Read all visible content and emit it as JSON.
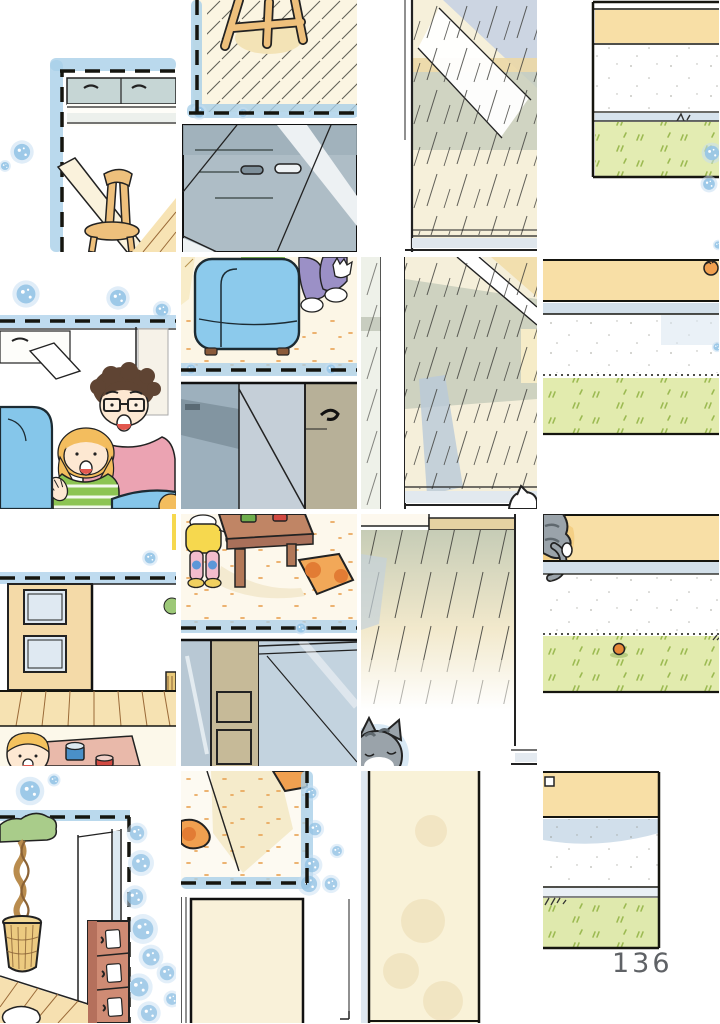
{
  "page": {
    "number": "136"
  },
  "illustration": {
    "kind": "scrambled watercolor manga-page illustration cut into 16 shuffled tiles",
    "grid": {
      "columns": 4,
      "rows": 4
    },
    "tiles": [
      {
        "id": "tile-kitchen-corner-chair",
        "desc": "kitchen wall cabinet corner, wooden chair and table edge, dashed panel border with blue watercolor"
      },
      {
        "id": "tile-stool-and-counter",
        "desc": "wooden stool on hatched floor above a gray kitchen counter block"
      },
      {
        "id": "tile-window-reflection",
        "desc": "glass pane with diagonal reflections, tan and green washes"
      },
      {
        "id": "tile-yard-strip-top",
        "desc": "horizontal bands: tan wall, white, sill, green grass strip"
      },
      {
        "id": "tile-family-peeking",
        "desc": "father with glasses and blond child smiling behind a blue sofa"
      },
      {
        "id": "tile-armchair-and-hallway",
        "desc": "blue armchair with seated legs above a dim hallway with door handle"
      },
      {
        "id": "tile-sliding-glass-door",
        "desc": "sliding glass door with washes, shadow and a white cat head below"
      },
      {
        "id": "tile-yard-strip-paw",
        "desc": "band strip with tiny orange paw, white band and grass"
      },
      {
        "id": "tile-door-and-play-table",
        "desc": "tan door with windows, wood floor, blond child with cups on a mat"
      },
      {
        "id": "tile-toddler-at-table",
        "desc": "toddler in yellow at brown table with cups, orange cushion, frames below"
      },
      {
        "id": "tile-deck-and-sleeping-cat",
        "desc": "hatched deck boards seen through glass, gray cat dozing at sill"
      },
      {
        "id": "tile-yard-strip-ball",
        "desc": "tabby cat tail over ledge, bands and grass with small orange ball"
      },
      {
        "id": "tile-plant-and-drawers",
        "desc": "braided topiary in basket, red-brown chest of drawers, heavy blue watercolor edge"
      },
      {
        "id": "tile-cushion-corner-door",
        "desc": "orange cushion corner on carpet above a cream door panel"
      },
      {
        "id": "tile-cream-door-panel",
        "desc": "tall cream door slab with black edges"
      },
      {
        "id": "tile-yard-strip-pagecorner",
        "desc": "tan band, sky wash, grass strip ending before page number"
      }
    ],
    "palette": {
      "paper": "#ffffff",
      "ink": "#1a1a18",
      "watercolor_blue": "#96c4e6",
      "watercolor_blue_light": "#c6def2",
      "wood_tan": "#eec07c",
      "floor_cream": "#fbf5e2",
      "cabinet_gray": "#aebdc6",
      "glass_green": "#c7cdbb",
      "grass_green": "#e2ebae",
      "grass_tuft": "#9cba52",
      "band_tan": "#f8dfa6",
      "band_sky": "#c9d9e8",
      "sofa_blue": "#85c6ea",
      "shirt_pink": "#eba3b2",
      "shirt_green": "#8cc453",
      "pants_purple": "#9b90c6",
      "hair_brown": "#5f4433",
      "hair_blond": "#f3bd5e",
      "skin": "#fde8d2",
      "cat_gray": "#9aa3aa",
      "cushion_orange": "#f0a050",
      "drawer_brown": "#cf8b74",
      "page_number_color": "#5f6266"
    }
  }
}
